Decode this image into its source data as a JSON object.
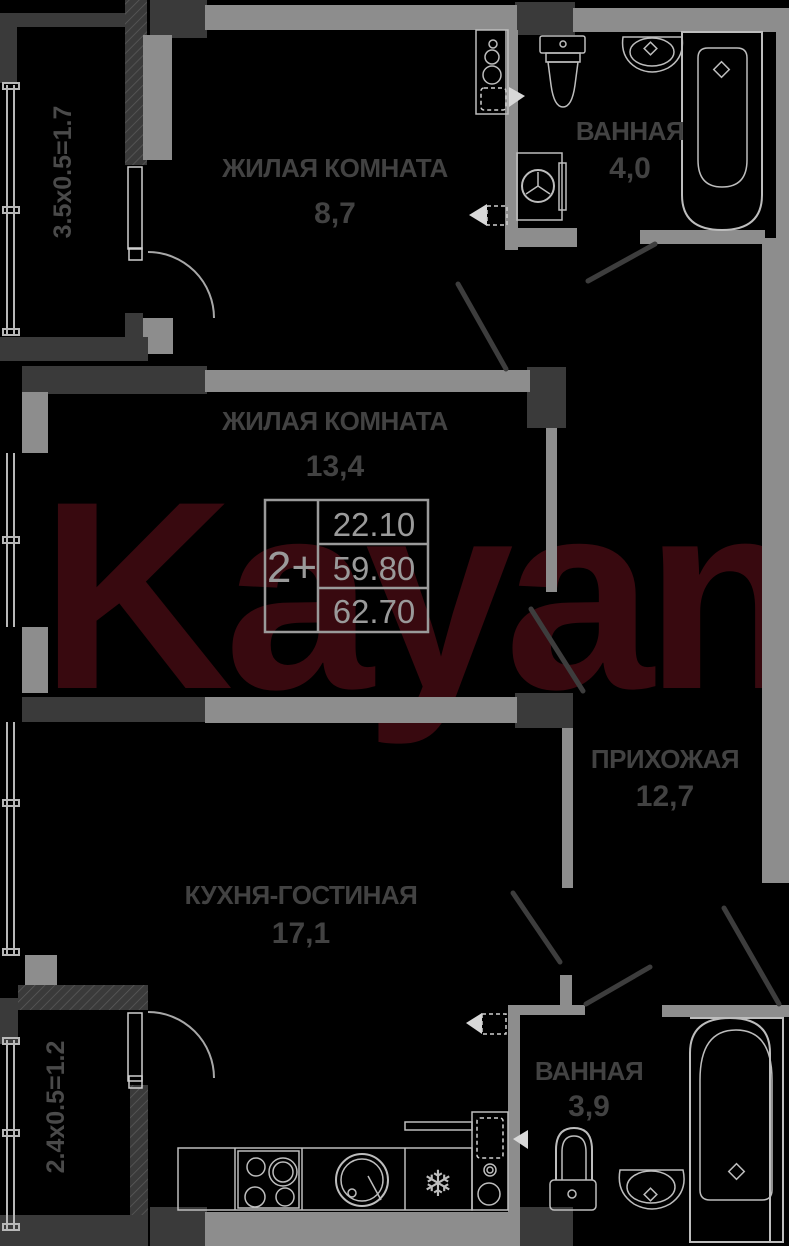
{
  "plan": {
    "watermark": {
      "text": "Kayan",
      "color": "#38090f"
    },
    "unit_table": {
      "type_label": "2+",
      "rows": [
        "22.10",
        "59.80",
        "62.70"
      ]
    },
    "rooms": [
      {
        "id": "living-room-1",
        "name": "ЖИЛАЯ КОМНАТА",
        "area": "8,7"
      },
      {
        "id": "living-room-2",
        "name": "ЖИЛАЯ КОМНАТА",
        "area": "13,4"
      },
      {
        "id": "bathroom-top",
        "name": "ВАННАЯ",
        "area": "4,0"
      },
      {
        "id": "hallway",
        "name": "ПРИХОЖАЯ",
        "area": "12,7"
      },
      {
        "id": "kitchen",
        "name": "КУХНЯ-ГОСТИНАЯ",
        "area": "17,1"
      },
      {
        "id": "bathroom-bottom",
        "name": "ВАННАЯ",
        "area": "3,9"
      }
    ],
    "balconies": [
      {
        "id": "balcony-top",
        "label": "3.5х0.5=1.7"
      },
      {
        "id": "balcony-bottom",
        "label": "2.4х0.5=1.2"
      }
    ],
    "colors": {
      "background": "#000000",
      "wall_light": "#8d8d8d",
      "wall_dark": "#3a3a3a",
      "fixture": "#bdbdbd",
      "room_label": "#424242",
      "table": "#9a9a9a"
    }
  }
}
